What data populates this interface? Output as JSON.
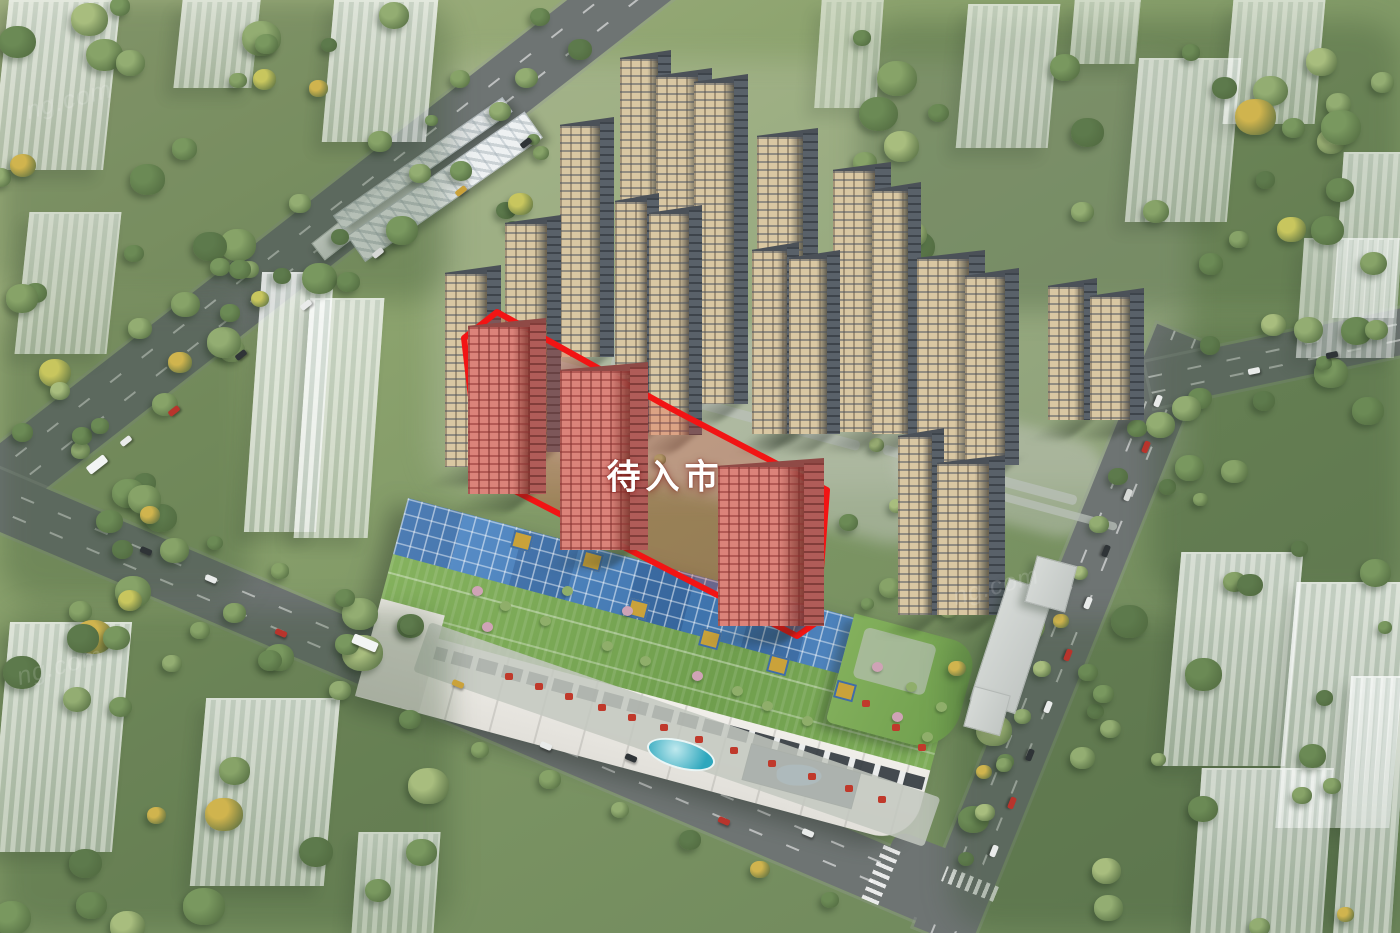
{
  "scene": {
    "title": "residential-masterplan-aerial-render",
    "label": {
      "text": "待入市",
      "color": "#ffffff"
    },
    "watermark_fragment": "ng.com",
    "colors": {
      "zone_outline": "#f21414",
      "zone_fill": "rgba(228,60,48,0.26)",
      "highlight_tower_face": "#db837a",
      "highlight_tower_side": "#b05c58",
      "highlight_tower_roof": "#8f4a46",
      "tower_face": "#d9c7a2",
      "tower_side": "#596169",
      "tower_roof": "#4b5158",
      "ghost_building": "rgba(236,242,240,0.72)",
      "grass": "#7b9362",
      "road": "#6e7473",
      "mall_glass": "#4a80bd",
      "mall_roof_green": "#7cab57",
      "mall_facade": "#eceae4",
      "pool": "#35b0c4",
      "bridge": "#dfe4e6",
      "canopy_red": "#c0392b",
      "gold_deco": "#caa23a"
    }
  }
}
